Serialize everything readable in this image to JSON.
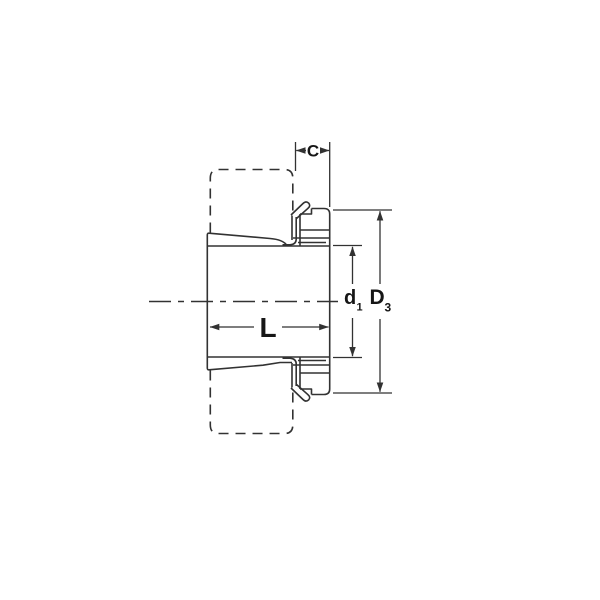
{
  "colors": {
    "background": "#ffffff",
    "line": "#323232",
    "text": "#161616"
  },
  "labels": {
    "c": "C",
    "l": "L",
    "d1_base": "d",
    "d1_sub": "1",
    "d3_base": "D",
    "d3_sub": "3"
  }
}
